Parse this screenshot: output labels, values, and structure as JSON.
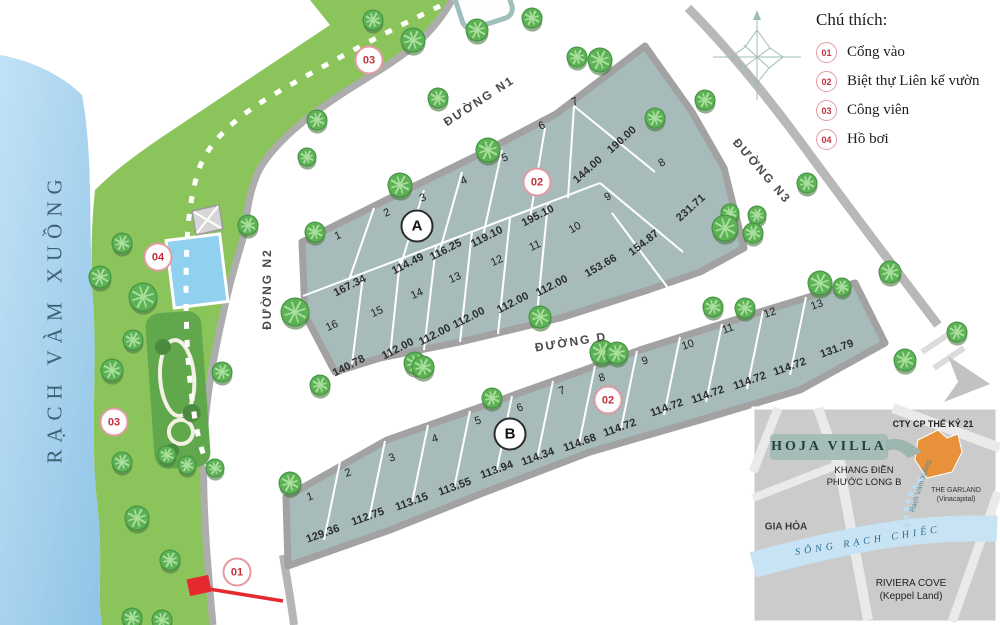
{
  "legend": {
    "title": "Chú thích:",
    "items": [
      {
        "id": "01",
        "label": "Cổng vào"
      },
      {
        "id": "02",
        "label": "Biệt thự Liên kế vườn"
      },
      {
        "id": "03",
        "label": "Công viên"
      },
      {
        "id": "04",
        "label": "Hồ bơi"
      }
    ]
  },
  "river_label": "RẠCH VÀM XUỒNG",
  "roads": [
    {
      "id": "n1",
      "name": "ĐƯỜNG N1",
      "x": 479,
      "y": 101,
      "rot": -33
    },
    {
      "id": "n2",
      "name": "ĐƯỜNG N2",
      "x": 267,
      "y": 289,
      "rot": -90
    },
    {
      "id": "n3",
      "name": "ĐƯỜNG N3",
      "x": 762,
      "y": 171,
      "rot": 49
    },
    {
      "id": "d",
      "name": "ĐƯỜNG D",
      "x": 571,
      "y": 342,
      "rot": -9
    }
  ],
  "blocks": {
    "A": {
      "badge": {
        "label": "A",
        "x": 417,
        "y": 226
      },
      "lots": [
        {
          "n": "1",
          "nx": 338,
          "ny": 236,
          "nr": -24,
          "dim": "167.34",
          "dx": 350,
          "dy": 286,
          "dr": -27
        },
        {
          "n": "2",
          "nx": 387,
          "ny": 213,
          "nr": -24,
          "dim": "114.49",
          "dx": 408,
          "dy": 264,
          "dr": -27
        },
        {
          "n": "3",
          "nx": 423,
          "ny": 198,
          "nr": -24,
          "dim": "116.25",
          "dx": 446,
          "dy": 250,
          "dr": -27
        },
        {
          "n": "4",
          "nx": 464,
          "ny": 181,
          "nr": -24,
          "dim": "119.10",
          "dx": 487,
          "dy": 237,
          "dr": -27
        },
        {
          "n": "5",
          "nx": 505,
          "ny": 158,
          "nr": -24,
          "dim": "195.10",
          "dx": 538,
          "dy": 216,
          "dr": -27
        },
        {
          "n": "6",
          "nx": 542,
          "ny": 126,
          "nr": -24,
          "dim": "144.00",
          "dx": 588,
          "dy": 170,
          "dr": -42
        },
        {
          "n": "7",
          "nx": 575,
          "ny": 102,
          "nr": -24,
          "dim": "190.00",
          "dx": 622,
          "dy": 140,
          "dr": -42
        },
        {
          "n": "8",
          "nx": 662,
          "ny": 163,
          "nr": -30,
          "dim": "231.71",
          "dx": 691,
          "dy": 208,
          "dr": -42
        },
        {
          "n": "9",
          "nx": 608,
          "ny": 197,
          "nr": -30,
          "dim": "154.87",
          "dx": 644,
          "dy": 243,
          "dr": -38
        },
        {
          "n": "10",
          "nx": 575,
          "ny": 228,
          "nr": -30,
          "dim": "153.66",
          "dx": 601,
          "dy": 266,
          "dr": -30
        },
        {
          "n": "11",
          "nx": 535,
          "ny": 246,
          "nr": -24,
          "dim": "112.00",
          "dx": 552,
          "dy": 286,
          "dr": -27
        },
        {
          "n": "12",
          "nx": 497,
          "ny": 261,
          "nr": -24,
          "dim": "112.00",
          "dx": 513,
          "dy": 303,
          "dr": -27
        },
        {
          "n": "13",
          "nx": 455,
          "ny": 278,
          "nr": -24,
          "dim": "112.00",
          "dx": 469,
          "dy": 318,
          "dr": -27
        },
        {
          "n": "14",
          "nx": 417,
          "ny": 294,
          "nr": -24,
          "dim": "112.00",
          "dx": 435,
          "dy": 335,
          "dr": -27
        },
        {
          "n": "15",
          "nx": 377,
          "ny": 312,
          "nr": -24,
          "dim": "112.00",
          "dx": 398,
          "dy": 349,
          "dr": -27
        },
        {
          "n": "16",
          "nx": 332,
          "ny": 326,
          "nr": -24,
          "dim": "140.78",
          "dx": 349,
          "dy": 366,
          "dr": -27
        }
      ]
    },
    "B": {
      "badge": {
        "label": "B",
        "x": 510,
        "y": 434
      },
      "lots": [
        {
          "n": "1",
          "nx": 310,
          "ny": 497,
          "nr": -19,
          "dim": "129.36",
          "dx": 323,
          "dy": 534,
          "dr": -20
        },
        {
          "n": "2",
          "nx": 348,
          "ny": 473,
          "nr": -19,
          "dim": "112.75",
          "dx": 368,
          "dy": 517,
          "dr": -20
        },
        {
          "n": "3",
          "nx": 392,
          "ny": 458,
          "nr": -19,
          "dim": "113.15",
          "dx": 412,
          "dy": 502,
          "dr": -20
        },
        {
          "n": "4",
          "nx": 435,
          "ny": 439,
          "nr": -19,
          "dim": "113.55",
          "dx": 455,
          "dy": 487,
          "dr": -20
        },
        {
          "n": "5",
          "nx": 478,
          "ny": 421,
          "nr": -19,
          "dim": "113.94",
          "dx": 497,
          "dy": 470,
          "dr": -20
        },
        {
          "n": "6",
          "nx": 520,
          "ny": 408,
          "nr": -19,
          "dim": "114.34",
          "dx": 538,
          "dy": 457,
          "dr": -20
        },
        {
          "n": "7",
          "nx": 562,
          "ny": 391,
          "nr": -19,
          "dim": "114.68",
          "dx": 580,
          "dy": 443,
          "dr": -20
        },
        {
          "n": "8",
          "nx": 602,
          "ny": 378,
          "nr": -19,
          "dim": "114.72",
          "dx": 620,
          "dy": 428,
          "dr": -20
        },
        {
          "n": "9",
          "nx": 645,
          "ny": 361,
          "nr": -19,
          "dim": "114.72",
          "dx": 667,
          "dy": 408,
          "dr": -20
        },
        {
          "n": "10",
          "nx": 688,
          "ny": 345,
          "nr": -19,
          "dim": "114.72",
          "dx": 708,
          "dy": 395,
          "dr": -20
        },
        {
          "n": "11",
          "nx": 728,
          "ny": 329,
          "nr": -19,
          "dim": "114.72",
          "dx": 750,
          "dy": 381,
          "dr": -20
        },
        {
          "n": "12",
          "nx": 770,
          "ny": 313,
          "nr": -19,
          "dim": "114.72",
          "dx": 790,
          "dy": 367,
          "dr": -20
        },
        {
          "n": "13",
          "nx": 817,
          "ny": 305,
          "nr": -19,
          "dim": "131.79",
          "dx": 837,
          "dy": 349,
          "dr": -20
        }
      ]
    }
  },
  "markers": [
    {
      "id": "03",
      "x": 369,
      "y": 60
    },
    {
      "id": "02",
      "x": 537,
      "y": 182
    },
    {
      "id": "04",
      "x": 158,
      "y": 257
    },
    {
      "id": "03",
      "x": 114,
      "y": 422
    },
    {
      "id": "01",
      "x": 237,
      "y": 572
    },
    {
      "id": "02",
      "x": 608,
      "y": 400
    }
  ],
  "trees": [
    [
      100,
      277,
      11
    ],
    [
      122,
      243,
      10
    ],
    [
      143,
      297,
      14
    ],
    [
      133,
      340,
      10
    ],
    [
      112,
      370,
      11
    ],
    [
      248,
      225,
      10
    ],
    [
      222,
      372,
      10
    ],
    [
      122,
      462,
      10
    ],
    [
      167,
      455,
      9
    ],
    [
      187,
      465,
      9
    ],
    [
      215,
      468,
      9
    ],
    [
      290,
      483,
      11
    ],
    [
      137,
      518,
      12
    ],
    [
      170,
      560,
      10
    ],
    [
      132,
      618,
      10
    ],
    [
      162,
      620,
      10
    ],
    [
      373,
      20,
      10
    ],
    [
      413,
      40,
      12
    ],
    [
      477,
      30,
      11
    ],
    [
      532,
      18,
      10
    ],
    [
      438,
      98,
      10
    ],
    [
      317,
      120,
      10
    ],
    [
      307,
      157,
      9
    ],
    [
      400,
      185,
      12
    ],
    [
      488,
      150,
      12
    ],
    [
      315,
      232,
      10
    ],
    [
      295,
      312,
      14
    ],
    [
      577,
      57,
      10
    ],
    [
      600,
      60,
      12
    ],
    [
      655,
      118,
      10
    ],
    [
      705,
      100,
      10
    ],
    [
      730,
      213,
      9
    ],
    [
      725,
      228,
      13
    ],
    [
      415,
      363,
      11
    ],
    [
      540,
      317,
      11
    ],
    [
      602,
      352,
      12
    ],
    [
      713,
      307,
      10
    ],
    [
      745,
      308,
      10
    ],
    [
      757,
      215,
      9
    ],
    [
      753,
      233,
      10
    ],
    [
      807,
      183,
      10
    ],
    [
      890,
      272,
      11
    ],
    [
      820,
      283,
      12
    ],
    [
      842,
      287,
      9
    ],
    [
      320,
      385,
      10
    ],
    [
      423,
      367,
      11
    ],
    [
      492,
      398,
      10
    ],
    [
      617,
      353,
      11
    ],
    [
      905,
      360,
      11
    ],
    [
      957,
      332,
      10
    ]
  ],
  "inset": {
    "cty": "CTY CP THẾ KỶ 21",
    "project": "HOJA VILLA",
    "khang_1": "KHANG ĐIỀN",
    "khang_2": "PHƯỚC LONG B",
    "garland_1": "THE GARLAND",
    "garland_2": "(Vinacapital)",
    "gia_hoa": "GIA HÒA",
    "river": "SÔNG RẠCH CHIẾC",
    "stream": "Rạch Vàm Xuồng",
    "riviera_1": "RIVIERA COVE",
    "riviera_2": "(Keppel Land)"
  }
}
